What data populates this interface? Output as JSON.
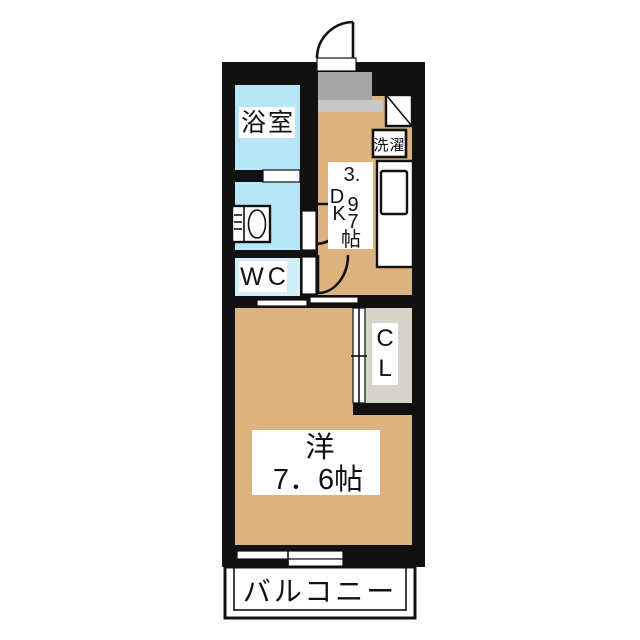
{
  "plan": {
    "bathroom": {
      "label": "浴室"
    },
    "laundry": {
      "label": "洗濯"
    },
    "wc": {
      "label": "WC"
    },
    "dk": {
      "name": "DK",
      "size": "3.97帖",
      "chars": {
        "c1": "3.",
        "c2": "D",
        "c3": "9",
        "c4": "K",
        "c5": "7",
        "c6": "帖"
      }
    },
    "closet": {
      "name": "CL",
      "chars": {
        "c1": "C",
        "c2": "L"
      }
    },
    "western": {
      "name": "洋",
      "size": "7．6帖"
    },
    "balcony": {
      "label": "バルコニー"
    }
  },
  "colors": {
    "wall": "#111111",
    "tan": "#dcb37e",
    "water_blue": "#b7e7f5",
    "wc_blue": "#d2eff8",
    "genkan_gray": "#a6a6a6",
    "step_gray": "#c7c7c7",
    "closet_gray": "#d7d4c9"
  }
}
